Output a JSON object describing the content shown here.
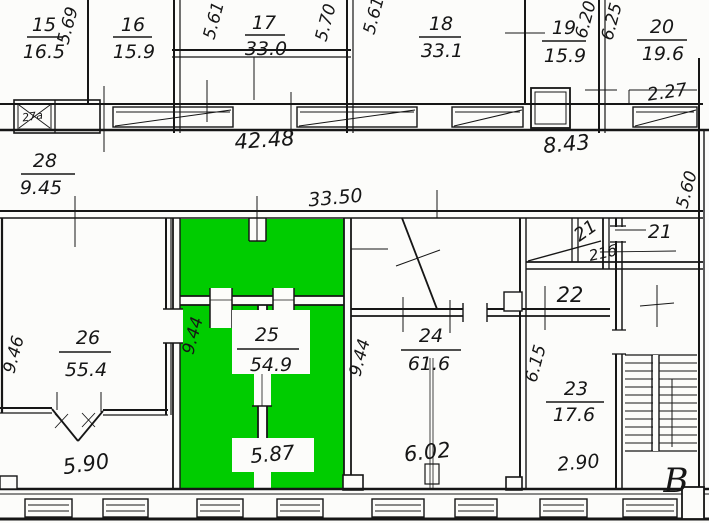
{
  "meta": {
    "title": "Building floor plan (hand-drawn survey) with highlighted room"
  },
  "colors": {
    "highlight_green": "#00cc00",
    "ink": "#161616",
    "paper": "#fcfcfa"
  },
  "rooms": {
    "r15": {
      "number": "15",
      "area": "16.5"
    },
    "r16": {
      "number": "16",
      "area": "15.9"
    },
    "r17": {
      "number": "17",
      "area": "33.0"
    },
    "r18": {
      "number": "18",
      "area": "33.1"
    },
    "r19": {
      "number": "19",
      "area": "15.9"
    },
    "r20": {
      "number": "20",
      "area": "19.6"
    },
    "r28": {
      "number": "28",
      "area": "9.45"
    },
    "r26": {
      "number": "26",
      "area": "55.4"
    },
    "r25": {
      "number": "25",
      "area": "54.9"
    },
    "r24": {
      "number": "24",
      "area": "61.6"
    },
    "r23": {
      "number": "23",
      "area": "17.6"
    },
    "r22": {
      "number": "22"
    },
    "r21": {
      "number": "21"
    },
    "r21s": {
      "number": "21"
    },
    "r21b": {
      "number": "21б"
    },
    "r27a": {
      "number": "27a"
    }
  },
  "dims": {
    "d569": "5.69",
    "d561a": "5.61",
    "d570": "5.70",
    "d561b": "5.61",
    "d620": "6.20",
    "d625": "6.25",
    "d227": "2.27",
    "d4248": "42.48",
    "d843": "8.43",
    "d560": "5.60",
    "d3350": "33.50",
    "d946": "9.46",
    "d944a": "9.44",
    "d944b": "9.44",
    "d615": "6.15",
    "d590": "5.90",
    "d587": "5.87",
    "d602": "6.02",
    "d290": "2.90"
  },
  "annotations": {
    "section_letter": "B"
  }
}
